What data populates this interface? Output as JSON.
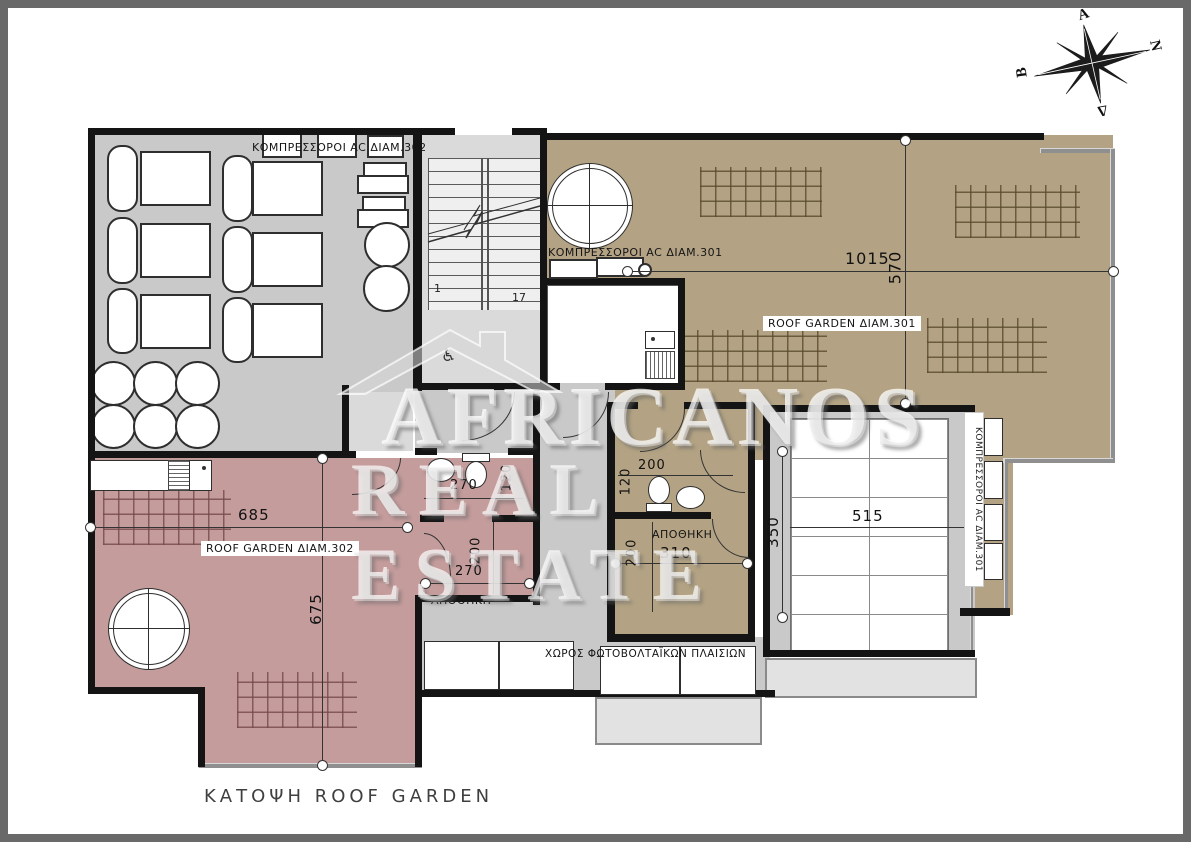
{
  "title": "ΚΑΤΟΨΗ ROOF GARDEN",
  "watermark": {
    "line1": "AFRICANOS",
    "line2": "REAL ESTATE"
  },
  "compass": {
    "east": "Α",
    "north": "Β",
    "south": "Ν",
    "west": "Δ"
  },
  "stairs": {
    "start_step": "1",
    "end_step": "17"
  },
  "rooms": {
    "terrace_302_label": "ΚΟΜΠΡΕΣΣΟΡΟΙ AC ΔΙΑΜ.302",
    "compressors_301_label": "ΚΟΜΠΡΕΣΣΟΡΟΙ AC ΔΙΑΜ.301",
    "compressors_301_vertical_label": "ΚΟΜΠΡΕΣΣΟΡΟΙ AC ΔΙΑΜ.301",
    "roof_garden_301_label": "ROOF GARDEN ΔΙΑΜ.301",
    "roof_garden_302_label": "ROOF GARDEN ΔΙΑΜ.302",
    "storage_301_label": "ΑΠΟΘΗΚΗ",
    "storage_302_label": "ΑΠΟΘΗΚΗ",
    "photovoltaic_label": "ΧΩΡΟΣ ΦΩΤΟΒΟΛΤΑΪΚΩΝ ΠΛΑΙΣΙΩΝ"
  },
  "dimensions": {
    "rg301_width": "1015",
    "rg301_depth": "570",
    "rg302_width": "685",
    "rg302_depth": "675",
    "wc302_width": "270",
    "wc302_depth": "120",
    "storage302_width": "270",
    "storage302_depth": "200",
    "wc301_width": "200",
    "wc301_depth": "120",
    "storage301_width": "310",
    "storage301_depth": "200",
    "storage301_side": "350",
    "panels_width": "515"
  },
  "colors": {
    "wall": "#141414",
    "tan": "#b3a384",
    "pink": "#c49c9c",
    "gray": "#c9c9c9"
  }
}
